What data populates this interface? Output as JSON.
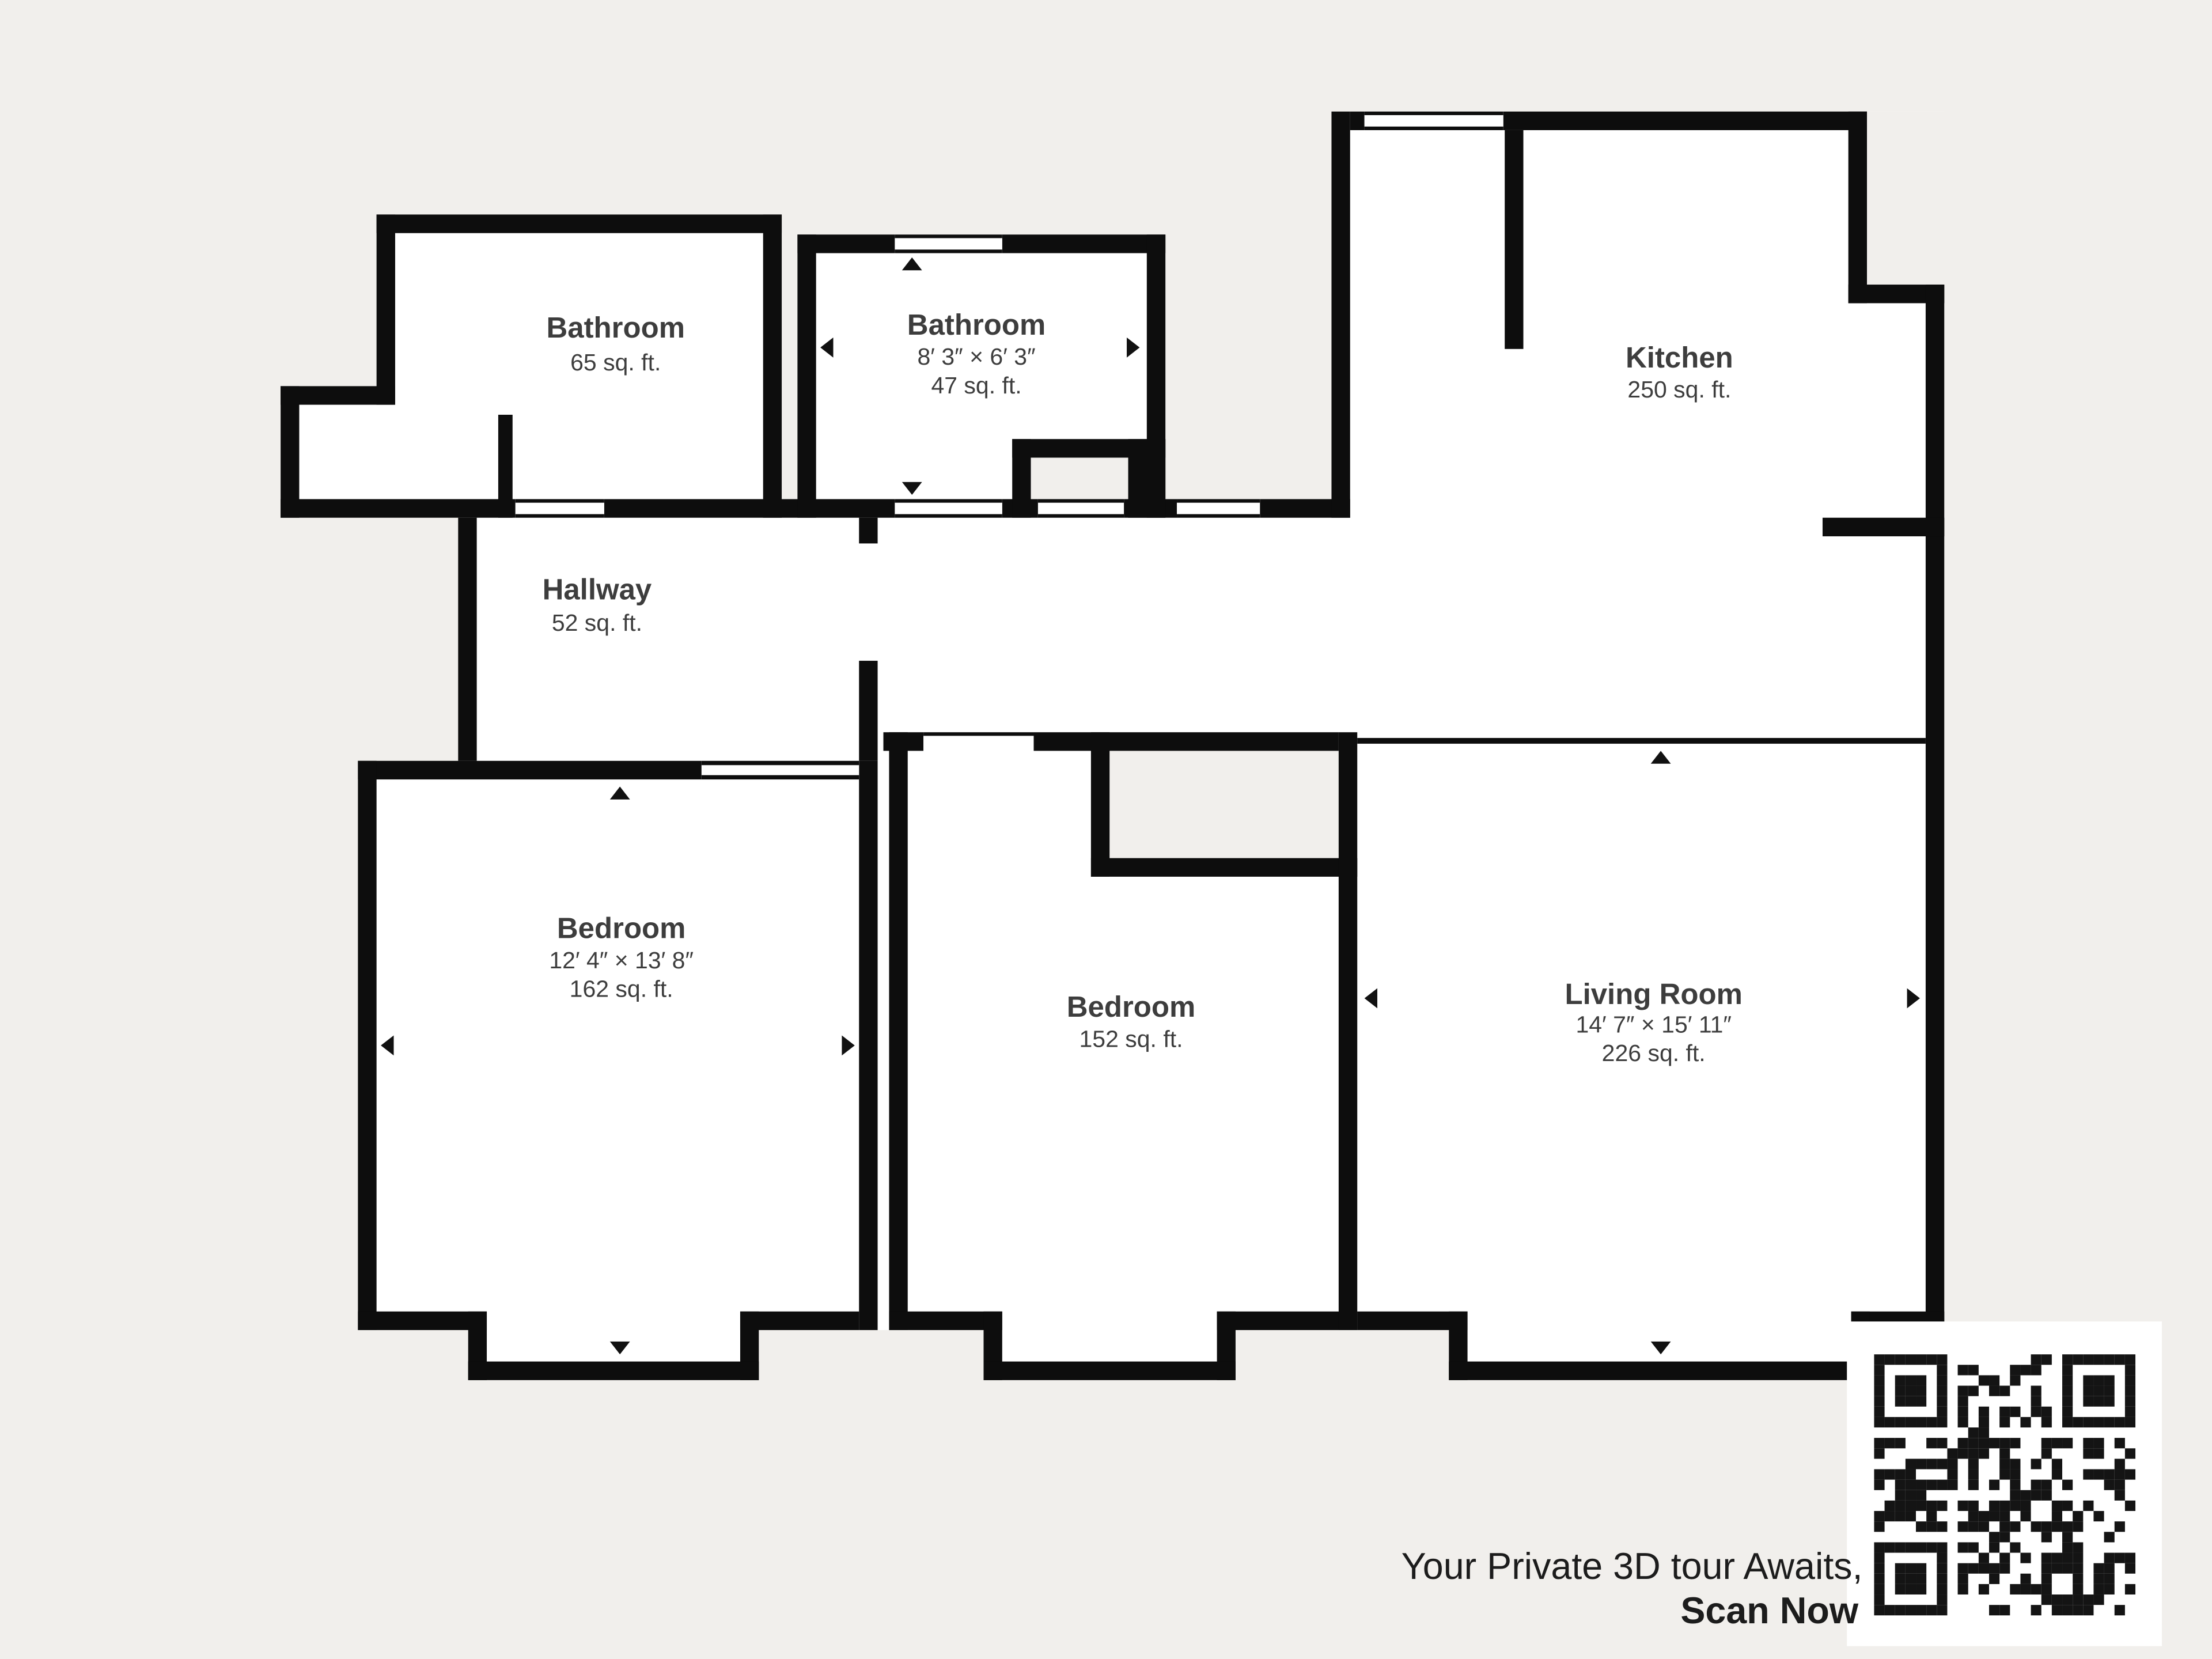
{
  "colors": {
    "background": "#f1efec",
    "wall": "#0d0d0d",
    "room_fill": "#ffffff",
    "label_text": "#3d3d3d",
    "caption_text": "#1c1c1c"
  },
  "rooms": {
    "bathroom_top_left": {
      "name": "Bathroom",
      "area": "65 sq. ft."
    },
    "bathroom_top_middle": {
      "name": "Bathroom",
      "dimensions": "8′ 3″ × 6′ 3″",
      "area": "47 sq. ft."
    },
    "kitchen": {
      "name": "Kitchen",
      "area": "250 sq. ft."
    },
    "hallway": {
      "name": "Hallway",
      "area": "52 sq. ft."
    },
    "bedroom_left": {
      "name": "Bedroom",
      "dimensions": "12′ 4″ × 13′ 8″",
      "area": "162 sq. ft."
    },
    "bedroom_middle": {
      "name": "Bedroom",
      "area": "152 sq. ft."
    },
    "living_room": {
      "name": "Living Room",
      "dimensions": "14′ 7″ × 15′ 11″",
      "area": "226 sq. ft."
    }
  },
  "door_markers": [
    {
      "room": "bathroom_top_middle",
      "directions": [
        "up",
        "down",
        "left",
        "right"
      ]
    },
    {
      "room": "bedroom_left",
      "directions": [
        "up",
        "down",
        "left",
        "right"
      ]
    },
    {
      "room": "living_room",
      "directions": [
        "up",
        "down",
        "left",
        "right"
      ]
    }
  ],
  "cta": {
    "line1": "Your Private 3D tour Awaits,",
    "line2": "Scan Now"
  },
  "qr": {
    "name": "qr-code",
    "purpose": "3D tour link"
  }
}
